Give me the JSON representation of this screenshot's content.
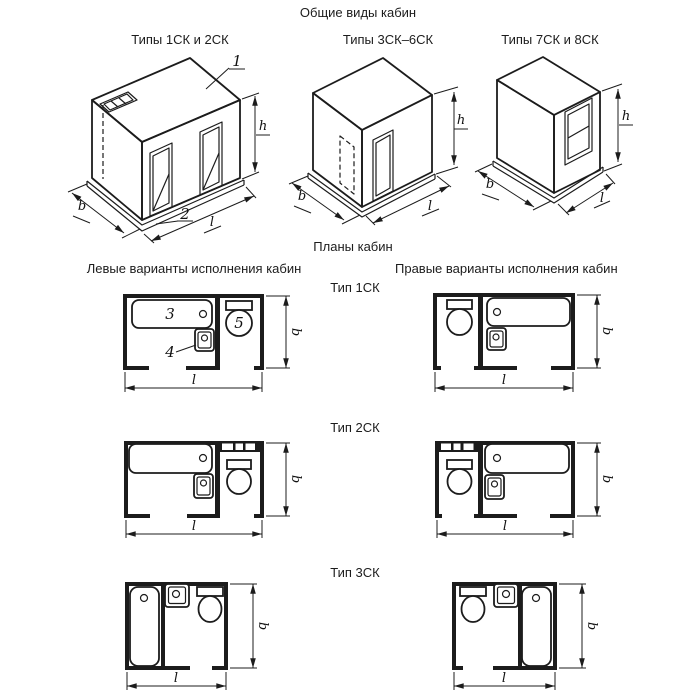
{
  "texts": {
    "general_views_title": "Общие виды кабин",
    "plans_title": "Планы кабин",
    "left_variants_caption": "Левые варианты исполнения кабин",
    "right_variants_caption": "Правые варианты исполнения кабин"
  },
  "iso_views": [
    {
      "caption": "Типы 1СК и 2СК"
    },
    {
      "caption": "Типы 3СК–6СК"
    },
    {
      "caption": "Типы 7СК и 8СК"
    }
  ],
  "plan_rows": [
    {
      "type_caption": "Тип 1СК"
    },
    {
      "type_caption": "Тип 2СК"
    },
    {
      "type_caption": "Тип 3СК"
    }
  ],
  "dim_labels": {
    "width": "b",
    "length": "l",
    "height": "h"
  },
  "callouts": {
    "ceiling_panel": "1",
    "base_panel": "2",
    "bathtub": "3",
    "washbasin": "4",
    "toilet": "5"
  },
  "colors": {
    "ink": "#1c1c1c",
    "paper": "#ffffff"
  }
}
